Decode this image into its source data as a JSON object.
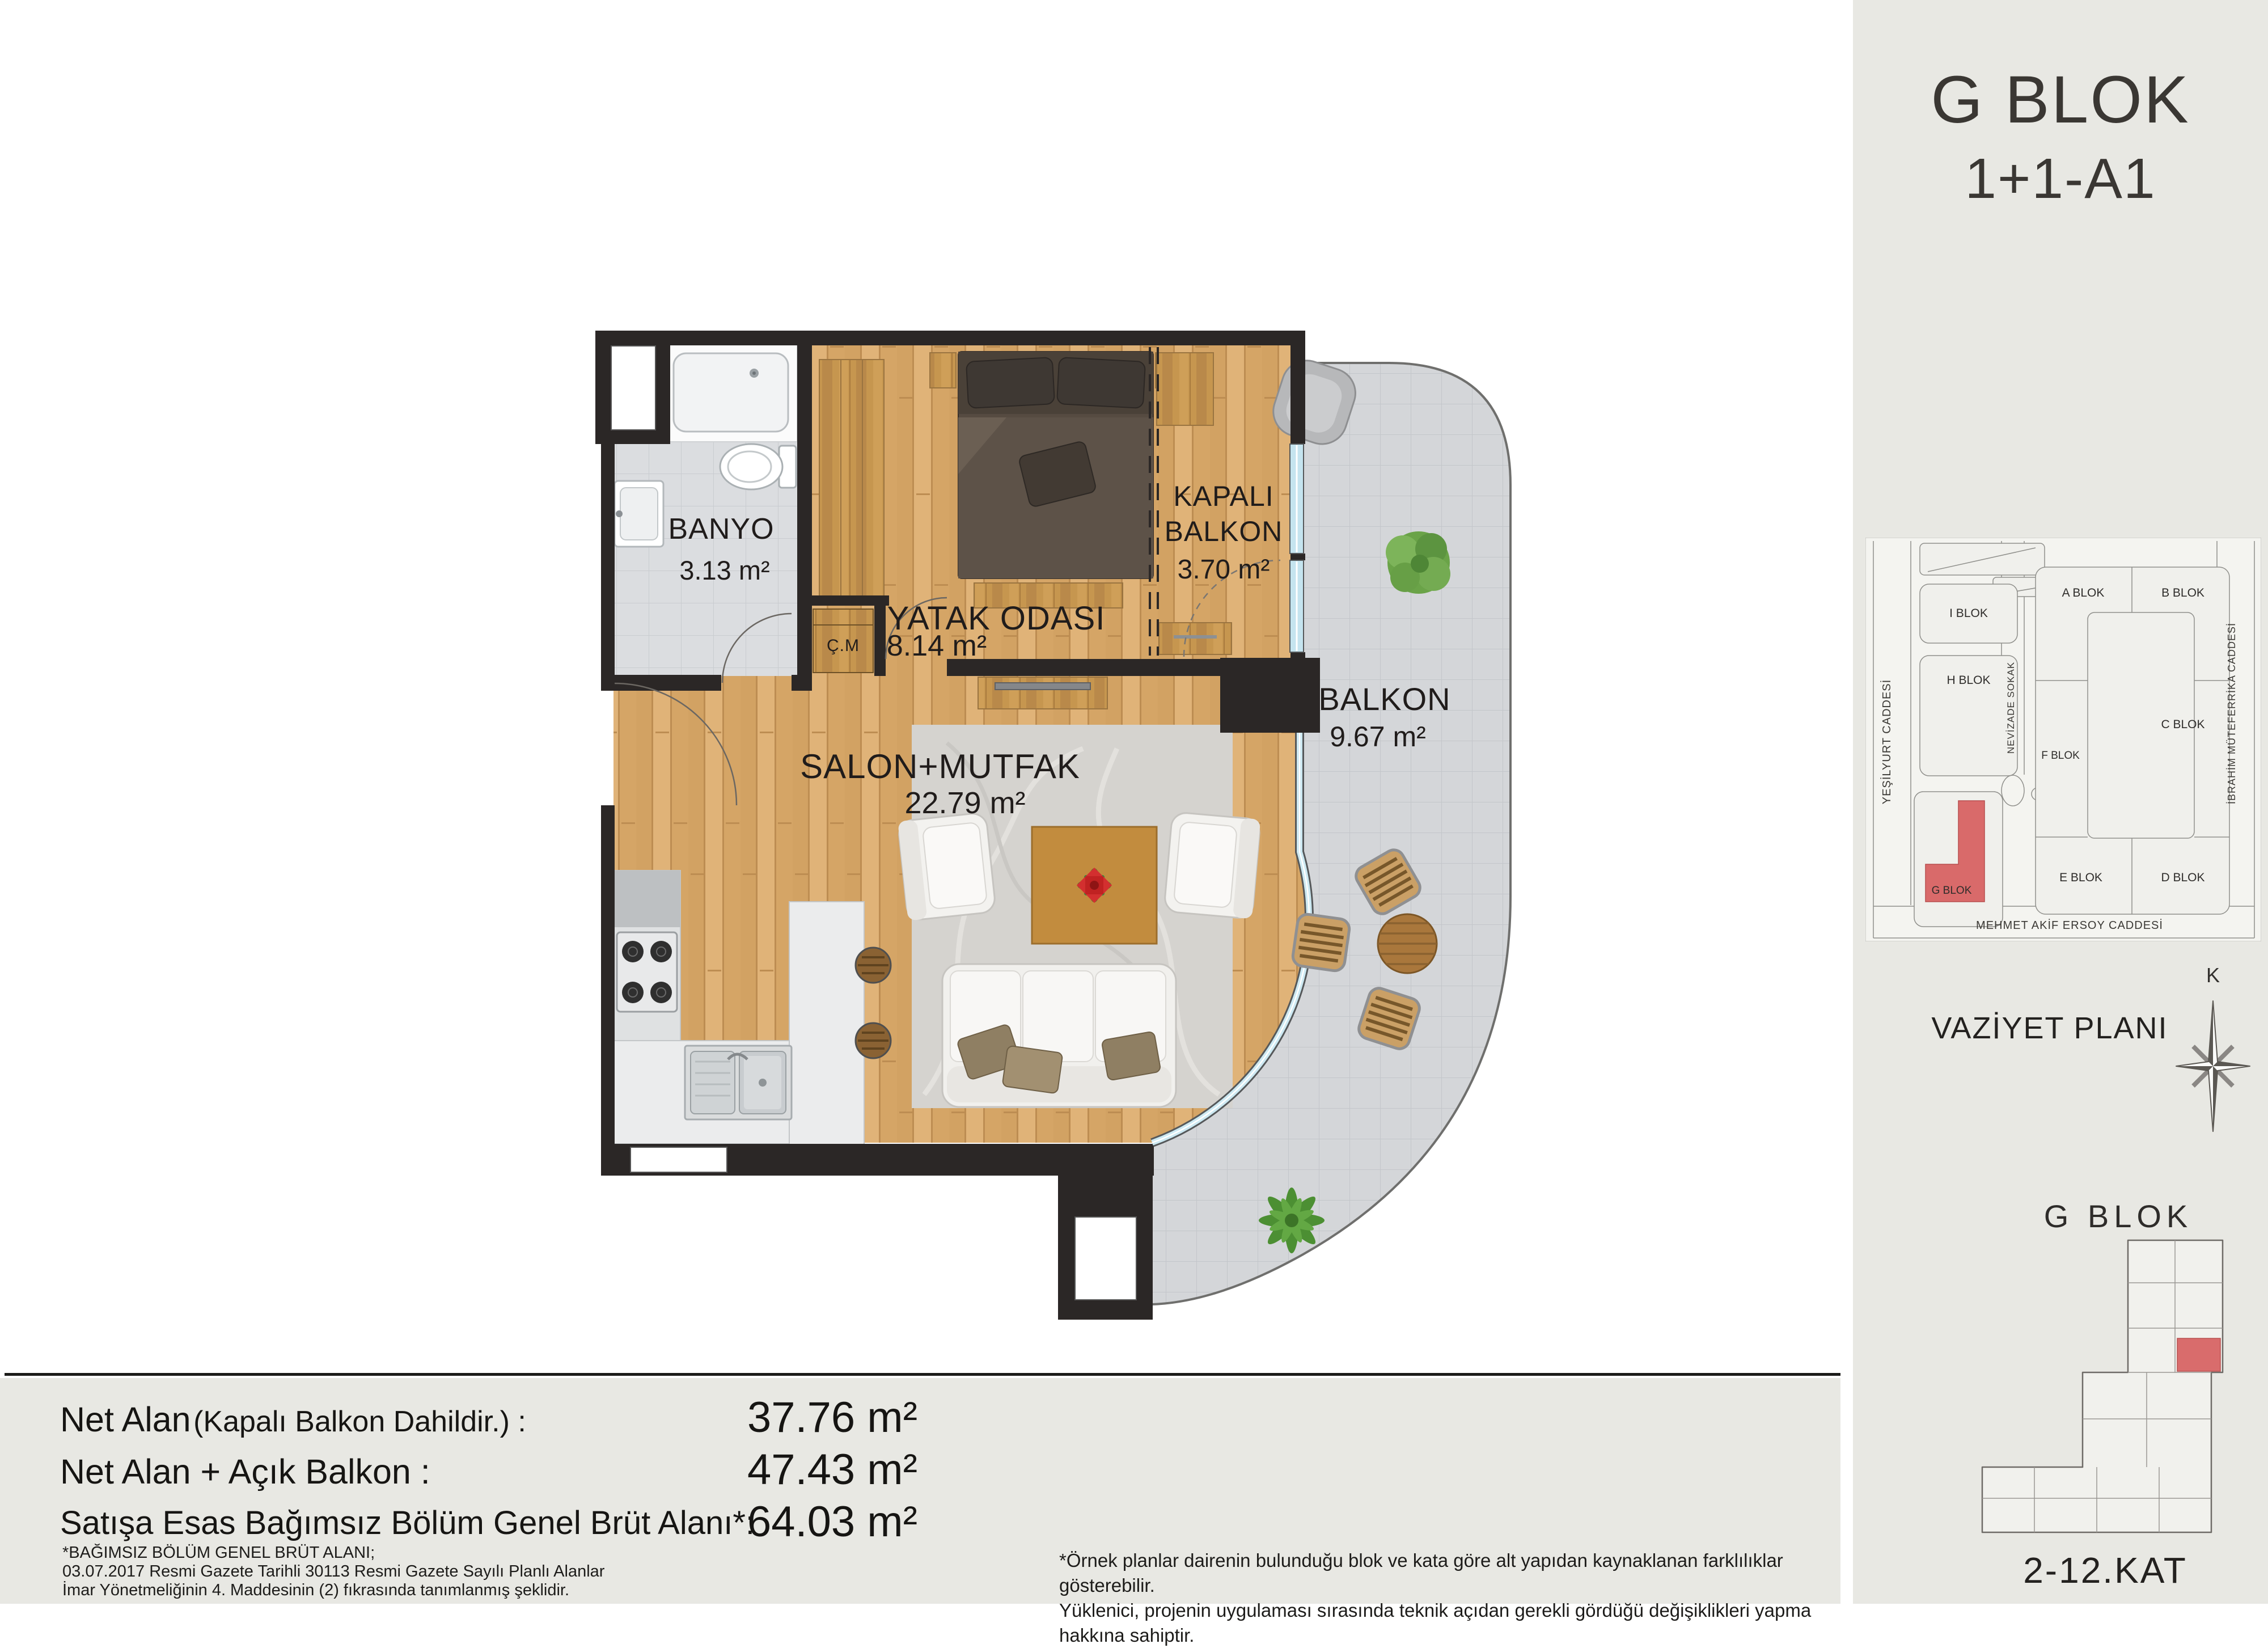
{
  "header": {
    "title": "G BLOK",
    "subtitle": "1+1-A1"
  },
  "plan": {
    "rooms": {
      "banyo": {
        "name": "BANYO",
        "area": "3.13 m²"
      },
      "cm": {
        "name": "Ç.M"
      },
      "yatak": {
        "name": "YATAK ODASI",
        "area": "8.14 m²"
      },
      "kapali": {
        "name_line1": "KAPALI",
        "name_line2": "BALKON",
        "area": "3.70 m²"
      },
      "balkon": {
        "name": "BALKON",
        "area": "9.67 m²"
      },
      "salon": {
        "name": "SALON+MUTFAK",
        "area": "22.79 m²"
      }
    }
  },
  "sidebar": {
    "map_title": "VAZİYET PLANI",
    "compass_label": "K",
    "highlight_color": "#d96a6a",
    "map": {
      "blocks": [
        {
          "label": "I BLOK"
        },
        {
          "label": "H BLOK"
        },
        {
          "label": "G BLOK"
        },
        {
          "label": "A BLOK"
        },
        {
          "label": "B BLOK"
        },
        {
          "label": "C BLOK"
        },
        {
          "label": "F BLOK"
        },
        {
          "label": "E BLOK"
        },
        {
          "label": "D BLOK"
        }
      ],
      "streets": {
        "left": "YEŞİLYURT CADDESİ",
        "middle": "NEVİZADE SOKAK",
        "right": "İBRAHİM MÜTEFERRİKA  CADDESİ",
        "bottom": "MEHMET AKİF ERSOY CADDESİ"
      }
    },
    "section": {
      "title": "G BLOK",
      "floors": "2-12.KAT"
    }
  },
  "summary": {
    "rows": [
      {
        "label": "Net Alan",
        "label_note": "(Kapalı Balkon Dahildir.) :",
        "value": "37.76 m²"
      },
      {
        "label": "Net Alan + Açık Balkon :",
        "label_note": "",
        "value": "47.43 m²"
      },
      {
        "label": "Satışa Esas Bağımsız Bölüm Genel Brüt Alanı*:",
        "label_note": "",
        "value": "64.03 m²"
      }
    ],
    "footnote": [
      "*BAĞIMSIZ BÖLÜM GENEL BRÜT ALANI;",
      "03.07.2017 Resmi Gazete Tarihli 30113 Resmi Gazete Sayılı  Planlı Alanlar",
      "İmar Yönetmeliğinin 4. Maddesinin (2) fıkrasında tanımlanmış şeklidir."
    ],
    "disclaimer": [
      "*Örnek planlar dairenin bulunduğu blok ve kata göre alt yapıdan kaynaklanan farklılıklar gösterebilir.",
      "Yüklenici, projenin uygulaması sırasında teknik açıdan gerekli gördüğü değişiklikleri yapma hakkına sahiptir."
    ]
  }
}
